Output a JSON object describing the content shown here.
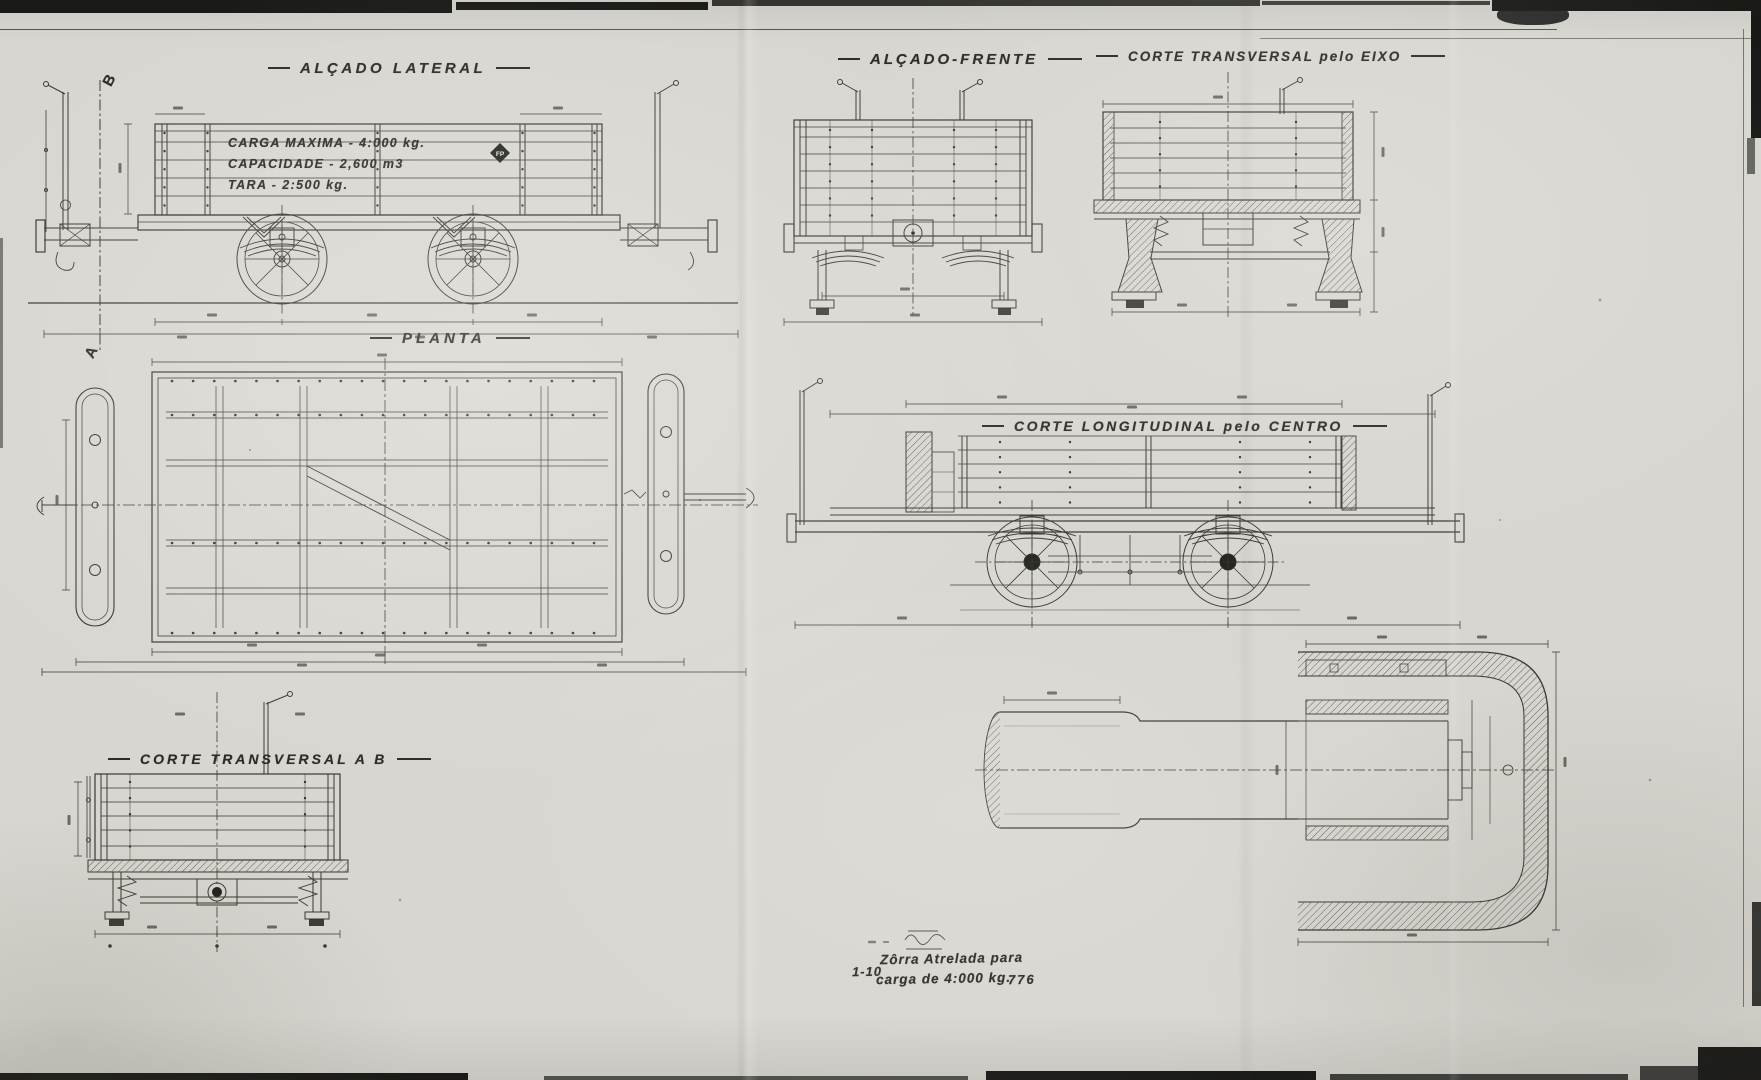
{
  "sheet": {
    "scale": "1-10",
    "number": "776",
    "title_line1": "Zôrra Atrelada para",
    "title_line2": "carga de 4:000 kg.",
    "colors": {
      "paper": "#d8d6d0",
      "ink": "#3a3831",
      "dark_ink": "#23231f"
    }
  },
  "view_titles": {
    "side": "ALÇADO LATERAL",
    "front": "ALÇADO-FRENTE",
    "axle_section": "CORTE TRANSVERSAL pelo EIXO",
    "plan": "PLANTA",
    "longitudinal_section": "CORTE LONGITUDINAL pelo CENTRO",
    "ab_section": "CORTE TRANSVERSAL A B"
  },
  "wagon_inscription": {
    "line1": "CARGA MAXIMA - 4:000 kg.",
    "line2": "CAPACIDADE - 2,600 m3",
    "line3": "TARA - 2:500 kg."
  },
  "markers": {
    "section_a": "A",
    "section_b": "B",
    "logo": "FP"
  }
}
